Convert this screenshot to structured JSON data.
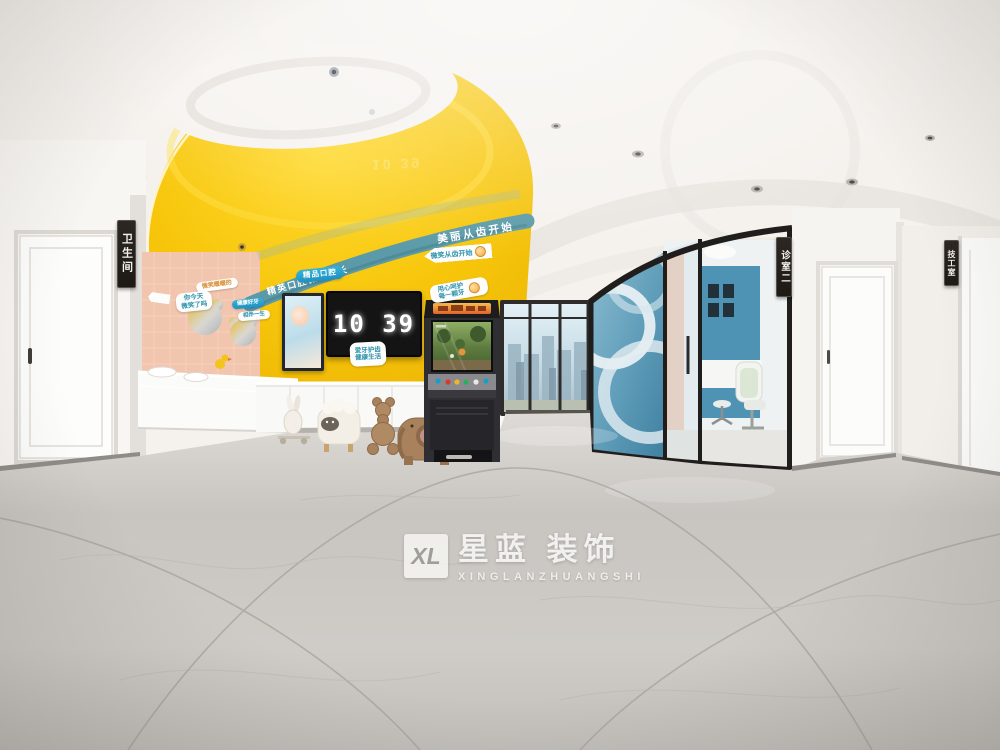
{
  "watermark": {
    "monogram": "XL",
    "brand": "星蓝 装饰",
    "latin": "XINGLANZHUANGSHI"
  },
  "clock": {
    "time": "10 39"
  },
  "signage": {
    "band_left": "精英口腔微笑成长",
    "band_right": "美丽从齿开始",
    "boutique": "精品口腔",
    "arrow": "微笑从齿开始",
    "tilted_line1": "用心呵护",
    "tilted_line2": "每一颗牙",
    "tv_tag_line1": "爱牙护齿",
    "tv_tag_line2": "健康生活",
    "door_left": "卫生间",
    "door_room2": "诊室二",
    "door_lab": "技工室",
    "pink_wall_1": "微笑暖暖的",
    "pink_wall_2": "你今天",
    "pink_wall_3": "微笑了吗",
    "pink_wall_4": "健康好牙",
    "pink_wall_5": "相伴一生"
  },
  "colors": {
    "dome_yellow": "#f6c50a",
    "band_teal": "#5b9aa8",
    "wall_pink": "#f2c5ae",
    "sign_blue": "#29a7cf",
    "glass_blue": "#5e9cb8",
    "floor_marble": "#c9c6c2"
  }
}
